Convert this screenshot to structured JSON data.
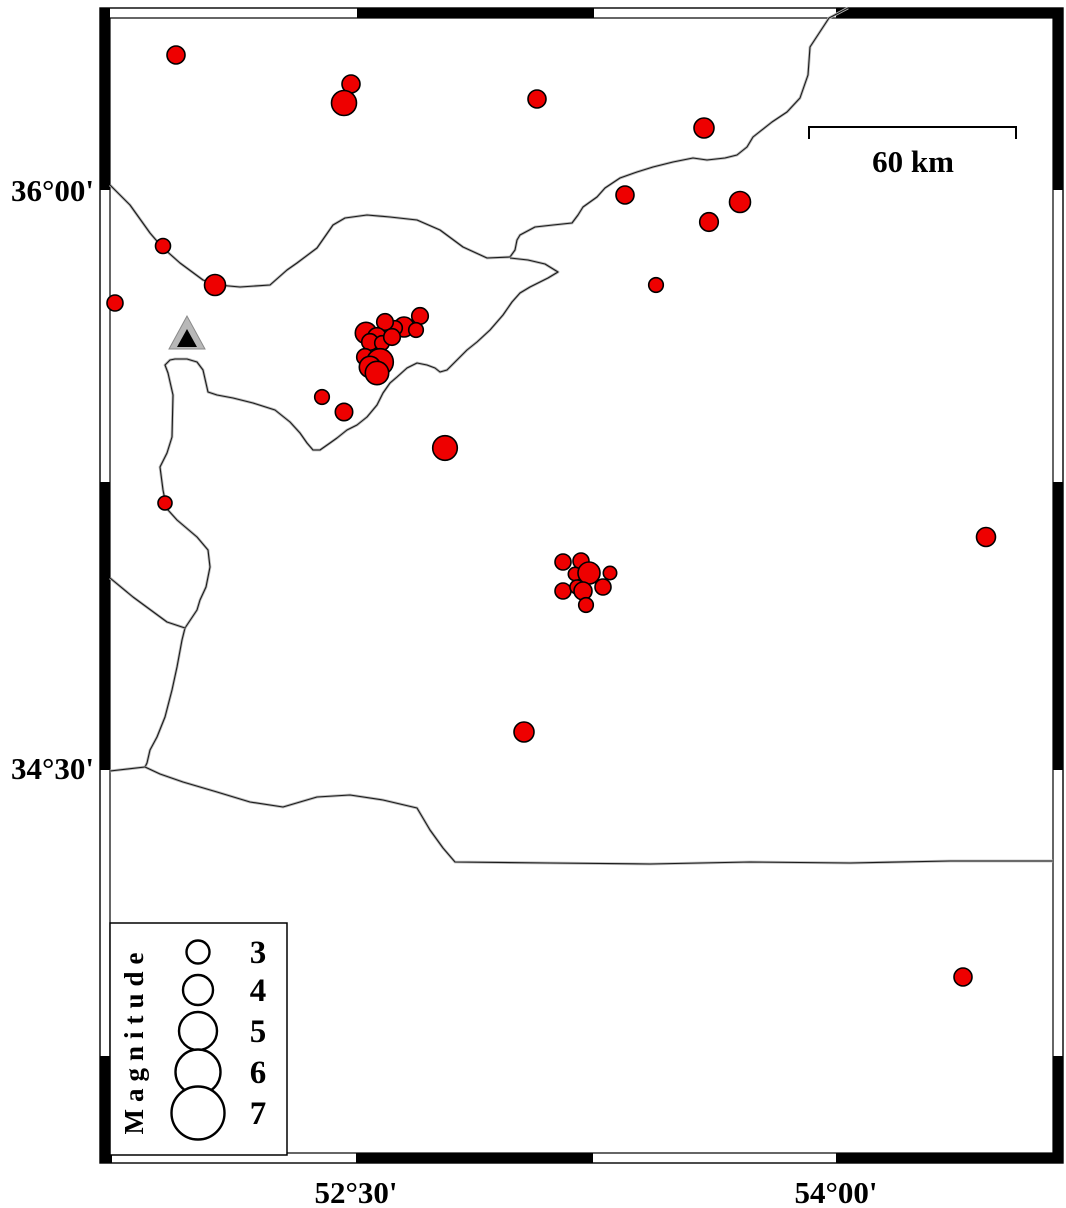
{
  "map": {
    "title": "",
    "colors": {
      "epicenter_fill": "#ee0000",
      "epicenter_stroke": "#000000",
      "coast_shadow": "#bbbbbb",
      "coast_line": "#1a1a1a",
      "frame_black": "#000000",
      "station_fill": "#b8b8b8",
      "station_inner": "#000000",
      "background": "#ffffff"
    },
    "frame": {
      "outer": [
        100,
        8,
        1063,
        1163
      ],
      "inner": [
        110,
        18,
        1053,
        1153
      ],
      "top_black_x": [
        [
          100,
          110
        ],
        [
          357,
          594
        ],
        [
          836,
          1063
        ]
      ],
      "bottom_black_x": [
        [
          100,
          112
        ],
        [
          356,
          593
        ],
        [
          836,
          1063
        ]
      ],
      "left_black_y": [
        [
          8,
          190
        ],
        [
          482,
          770
        ],
        [
          1056,
          1163
        ]
      ],
      "right_black_y": [
        [
          8,
          190
        ],
        [
          482,
          770
        ],
        [
          1056,
          1163
        ]
      ]
    },
    "axis_labels": {
      "left": [
        {
          "text": "36°00'",
          "x": 94,
          "y": 201
        },
        {
          "text": "34°30'",
          "x": 94,
          "y": 779
        }
      ],
      "bottom": [
        {
          "text": "52°30'",
          "x": 356,
          "y": 1203
        },
        {
          "text": "54°00'",
          "x": 836,
          "y": 1203
        }
      ]
    },
    "scale_bar": {
      "label": "60 km",
      "x1": 809,
      "x2": 1016,
      "y": 127,
      "tick_drop": 12,
      "label_x": 913,
      "label_y": 172
    },
    "legend": {
      "title": "Magnitude",
      "box": [
        110,
        923,
        177,
        232
      ],
      "title_x": 143,
      "title_y": 1040,
      "circle_x": 198,
      "value_x": 258,
      "entries": [
        {
          "label": "3",
          "cy": 952,
          "r": 11.5
        },
        {
          "label": "4",
          "cy": 990,
          "r": 15
        },
        {
          "label": "5",
          "cy": 1031,
          "r": 19
        },
        {
          "label": "6",
          "cy": 1072,
          "r": 22.5
        },
        {
          "label": "7",
          "cy": 1113,
          "r": 26.5
        }
      ]
    },
    "station": {
      "outer_points": "187,316 169,349 205,349",
      "inner_points": "187,329 177,347 197,347"
    },
    "earthquakes": [
      [
        176,
        55,
        9
      ],
      [
        351,
        84,
        9
      ],
      [
        344,
        103,
        12.5
      ],
      [
        537,
        99,
        9
      ],
      [
        704,
        128,
        10
      ],
      [
        625,
        195,
        9
      ],
      [
        740,
        202,
        10.5
      ],
      [
        709,
        222,
        9.3
      ],
      [
        656,
        285,
        7.3
      ],
      [
        163,
        246,
        7.5
      ],
      [
        215,
        285,
        10.5
      ],
      [
        115,
        303,
        8
      ],
      [
        420,
        316,
        8.3
      ],
      [
        404,
        327,
        10
      ],
      [
        416,
        330,
        7.3
      ],
      [
        395,
        328,
        7.3
      ],
      [
        385,
        322,
        8.3
      ],
      [
        366,
        333,
        10.7
      ],
      [
        377,
        337,
        9.3
      ],
      [
        370,
        342,
        8.3
      ],
      [
        382,
        343,
        7.3
      ],
      [
        392,
        337,
        8.3
      ],
      [
        365,
        357,
        8.3
      ],
      [
        380,
        362,
        13.3
      ],
      [
        370,
        367,
        10.7
      ],
      [
        377,
        373,
        11.7
      ],
      [
        322,
        397,
        7.3
      ],
      [
        344,
        412,
        8.7
      ],
      [
        445,
        448,
        12.3
      ],
      [
        165,
        503,
        7
      ],
      [
        986,
        537,
        9.5
      ],
      [
        563,
        562,
        8
      ],
      [
        581,
        561,
        8
      ],
      [
        575,
        574,
        6.7
      ],
      [
        589,
        573,
        11
      ],
      [
        610,
        573,
        6.7
      ],
      [
        563,
        591,
        8
      ],
      [
        577,
        587,
        7
      ],
      [
        583,
        591,
        9
      ],
      [
        603,
        587,
        8
      ],
      [
        586,
        605,
        7.3
      ],
      [
        524,
        732,
        10
      ],
      [
        963,
        977,
        9
      ]
    ],
    "coastlines": [
      {
        "name": "caspian-west-coast",
        "points": [
          [
            848,
            8
          ],
          [
            829,
            18
          ],
          [
            810,
            47
          ],
          [
            808,
            75
          ],
          [
            800,
            98
          ],
          [
            787,
            112
          ],
          [
            772,
            122
          ],
          [
            753,
            137
          ],
          [
            747,
            147
          ],
          [
            737,
            155
          ],
          [
            725,
            158
          ],
          [
            707,
            160
          ],
          [
            693,
            158
          ],
          [
            673,
            162
          ],
          [
            653,
            167
          ],
          [
            637,
            172
          ],
          [
            620,
            178
          ],
          [
            605,
            188
          ],
          [
            597,
            197
          ],
          [
            583,
            207
          ],
          [
            578,
            215
          ],
          [
            572,
            223
          ],
          [
            553,
            225
          ],
          [
            535,
            227
          ],
          [
            520,
            235
          ],
          [
            517,
            240
          ],
          [
            515,
            250
          ],
          [
            510,
            257
          ],
          [
            487,
            258
          ],
          [
            463,
            247
          ],
          [
            440,
            230
          ],
          [
            417,
            220
          ],
          [
            390,
            217
          ],
          [
            367,
            215
          ],
          [
            345,
            218
          ],
          [
            333,
            225
          ],
          [
            317,
            248
          ],
          [
            297,
            263
          ],
          [
            287,
            270
          ],
          [
            270,
            285
          ],
          [
            240,
            287
          ],
          [
            218,
            285
          ],
          [
            203,
            280
          ],
          [
            180,
            263
          ],
          [
            162,
            247
          ],
          [
            150,
            233
          ],
          [
            130,
            205
          ],
          [
            110,
            185
          ]
        ]
      },
      {
        "name": "south-caspian-coast",
        "points": [
          [
            510,
            258
          ],
          [
            528,
            260
          ],
          [
            545,
            264
          ],
          [
            558,
            272
          ],
          [
            548,
            278
          ],
          [
            530,
            287
          ],
          [
            520,
            293
          ],
          [
            512,
            302
          ],
          [
            503,
            315
          ],
          [
            490,
            330
          ],
          [
            477,
            342
          ],
          [
            467,
            350
          ],
          [
            457,
            360
          ],
          [
            447,
            370
          ],
          [
            440,
            372
          ],
          [
            435,
            368
          ],
          [
            427,
            365
          ],
          [
            417,
            363
          ],
          [
            407,
            368
          ],
          [
            397,
            377
          ],
          [
            390,
            383
          ],
          [
            383,
            393
          ],
          [
            377,
            405
          ],
          [
            367,
            417
          ],
          [
            357,
            425
          ],
          [
            347,
            430
          ],
          [
            337,
            438
          ],
          [
            330,
            443
          ],
          [
            320,
            450
          ],
          [
            313,
            450
          ],
          [
            307,
            443
          ],
          [
            300,
            433
          ],
          [
            290,
            422
          ],
          [
            275,
            410
          ],
          [
            253,
            403
          ],
          [
            233,
            398
          ],
          [
            217,
            395
          ],
          [
            208,
            392
          ],
          [
            203,
            370
          ],
          [
            197,
            362
          ],
          [
            187,
            359
          ],
          [
            175,
            359
          ],
          [
            170,
            360
          ],
          [
            165,
            365
          ],
          [
            168,
            373
          ],
          [
            173,
            395
          ],
          [
            172,
            437
          ],
          [
            167,
            453
          ],
          [
            160,
            467
          ],
          [
            163,
            490
          ],
          [
            165,
            500
          ],
          [
            168,
            510
          ],
          [
            177,
            520
          ],
          [
            197,
            537
          ],
          [
            208,
            550
          ],
          [
            210,
            567
          ],
          [
            206,
            587
          ],
          [
            200,
            600
          ],
          [
            197,
            610
          ],
          [
            185,
            628
          ],
          [
            182,
            640
          ],
          [
            177,
            667
          ],
          [
            172,
            690
          ],
          [
            165,
            717
          ],
          [
            157,
            737
          ],
          [
            150,
            750
          ],
          [
            147,
            763
          ],
          [
            145,
            767
          ],
          [
            110,
            771
          ]
        ]
      },
      {
        "name": "border-west",
        "points": [
          [
            110,
            578
          ],
          [
            133,
            597
          ],
          [
            167,
            622
          ],
          [
            185,
            628
          ]
        ]
      },
      {
        "name": "border-south",
        "points": [
          [
            145,
            767
          ],
          [
            160,
            774
          ],
          [
            183,
            782
          ],
          [
            217,
            792
          ],
          [
            250,
            802
          ],
          [
            283,
            807
          ],
          [
            317,
            797
          ],
          [
            350,
            795
          ],
          [
            383,
            800
          ],
          [
            417,
            808
          ],
          [
            430,
            830
          ],
          [
            443,
            848
          ],
          [
            455,
            862
          ],
          [
            550,
            863
          ],
          [
            650,
            864
          ],
          [
            750,
            862
          ],
          [
            850,
            863
          ],
          [
            950,
            861
          ],
          [
            1053,
            861
          ]
        ]
      }
    ]
  }
}
